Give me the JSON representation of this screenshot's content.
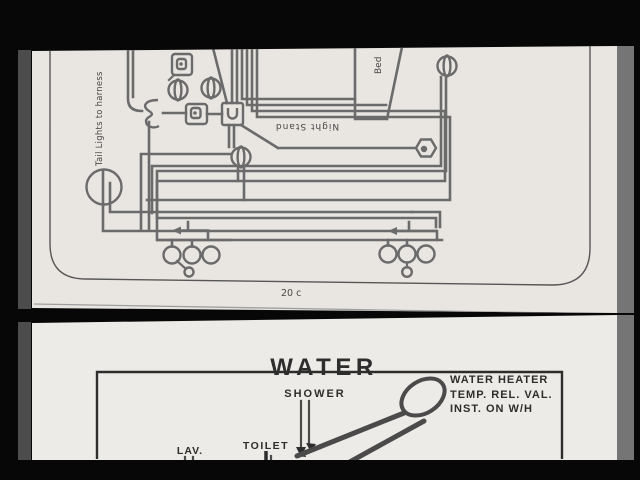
{
  "colors": {
    "background": "#070707",
    "paper_top": "#e9e6e2",
    "paper_bottom": "#edebe7",
    "wire": "#6b6b6b",
    "outline": "#565656",
    "ink_top": "#474747",
    "ink_bottom": "#2d2d2d",
    "pipe": "#4a4a4a",
    "strip_left": "#4c4c4c",
    "strip_right": "#757575",
    "crease": "#9f9f9f"
  },
  "top_page": {
    "tail_lights_label": "Tail Lights to harness",
    "bed_label": "Bed",
    "night_stand_label": "Night Stand",
    "page_number": "20 c"
  },
  "bottom_page": {
    "title": "WATER",
    "shower_label": "SHOWER",
    "lav_label": "LAV.",
    "toilet_label": "TOILET",
    "water_heater_note": [
      "WATER HEATER",
      "TEMP. REL. VAL.",
      "INST. ON W/H"
    ]
  }
}
